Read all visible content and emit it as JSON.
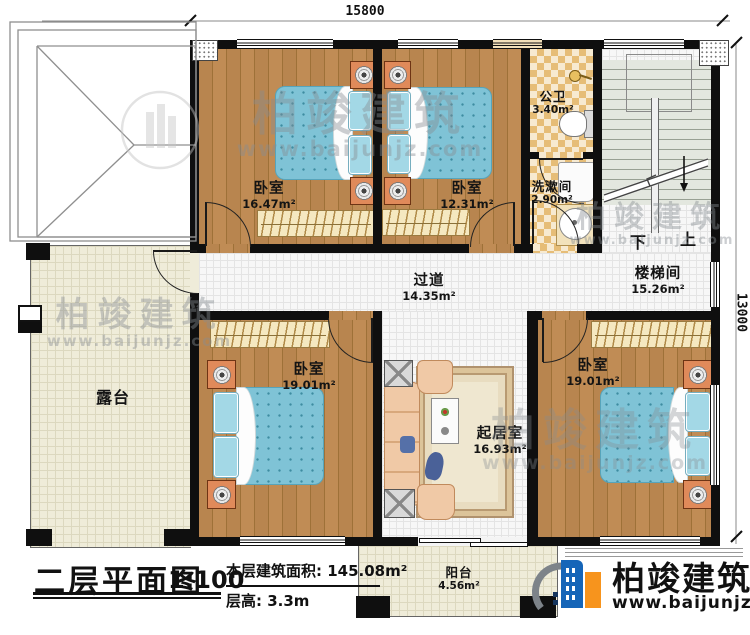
{
  "plan": {
    "dimensions": {
      "width": "15800",
      "height": "13000"
    },
    "rooms": [
      {
        "id": "bedroom-top-left",
        "name": "卧室",
        "area": "16.47m²"
      },
      {
        "id": "bedroom-top-mid",
        "name": "卧室",
        "area": "12.31m²"
      },
      {
        "id": "public-bathroom",
        "name": "公卫",
        "area": "3.40m²"
      },
      {
        "id": "washroom",
        "name": "洗漱间",
        "area": "2.90m²"
      },
      {
        "id": "stairwell",
        "name": "楼梯间",
        "area": "15.26m²"
      },
      {
        "id": "corridor",
        "name": "过道",
        "area": "14.35m²"
      },
      {
        "id": "bedroom-bot-left",
        "name": "卧室",
        "area": "19.01m²"
      },
      {
        "id": "living-room",
        "name": "起居室",
        "area": "16.93m²"
      },
      {
        "id": "bedroom-bot-right",
        "name": "卧室",
        "area": "19.01m²"
      },
      {
        "id": "terrace",
        "name": "露台",
        "area": ""
      },
      {
        "id": "balcony",
        "name": "阳台",
        "area": "4.56m²"
      }
    ],
    "stairs": {
      "down": "下",
      "up": "上"
    }
  },
  "titleblock": {
    "title": "二层平面图",
    "scale": "1:100",
    "area_label": "本层建筑面积:",
    "area_value": "145.08m²",
    "height_label": "层高:",
    "height_value": "3.3m"
  },
  "logo": {
    "name": "柏竣建筑",
    "url": "www.baijunjz.com"
  },
  "watermark": {
    "name": "柏竣建筑",
    "url": "www.baijunjz.com"
  },
  "colors": {
    "wall": "#0f0f0f",
    "wood_floor": "#b5834d",
    "bedding": "#7fc3d6",
    "bath_tile": "#e6bd77",
    "terrace_floor": "#efecd9",
    "logo_blue": "#1565b8",
    "logo_orange": "#f7941d"
  }
}
